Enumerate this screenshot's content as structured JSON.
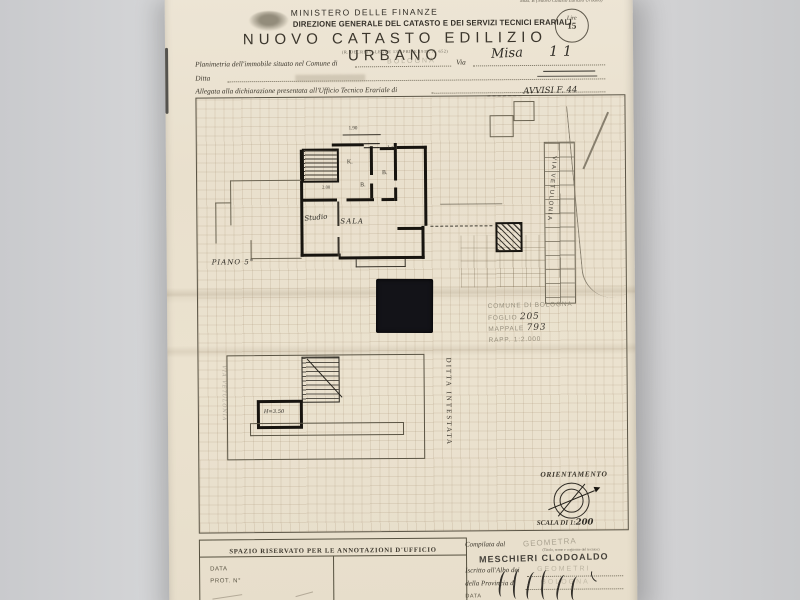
{
  "header": {
    "mod_label": "Mod. B (Nuovo Catasto Edilizio Urbano)",
    "ministry": "MINISTERO DELLE FINANZE",
    "directorate": "DIREZIONE GENERALE DEL CATASTO E DEI SERVIZI TECNICI ERARIALI",
    "title": "NUOVO CATASTO EDILIZIO URBANO",
    "subtitle": "(R. DECRETO-LEGGE 13 APRILE 1939, N. 652)",
    "fee_stamp": {
      "currency": "Lire",
      "amount": "15"
    }
  },
  "form": {
    "line1_label": "Planimetria dell'immobile situato nel Comune di",
    "comune_stamp": "BOLOGNA",
    "via_label": "Via",
    "via_value": "Misa",
    "civico_value": "11",
    "ditta_label": "Ditta",
    "line3_label": "Allegata alla dichiarazione presentata all'Ufficio Tecnico Erariale di",
    "annotation": "AVVISI F. 44"
  },
  "plan_upper": {
    "floor_label": "PIANO 5°",
    "rooms": {
      "kitchen": "K.",
      "bath1": "B.",
      "bath2": "B.",
      "sala": "SALA",
      "studio": "Studio"
    },
    "dims": {
      "top": "1.90",
      "right": "1.15",
      "hall": "2.00"
    }
  },
  "site_plan": {
    "street": "VIA VETULONIA",
    "stamp": {
      "line1": "COMUNE DI BOLOGNA",
      "foglio_label": "FOGLIO",
      "foglio_value": "205",
      "mappale_label": "MAPPALE",
      "mappale_value": "793",
      "rapp": "RAPP. 1:2.000"
    }
  },
  "plan_lower": {
    "height_label": "H=3.50",
    "ditta_vertical": "DITTA INTESTATA",
    "street_pencil": "VIA VETULONIA"
  },
  "orientation": {
    "label": "ORIENTAMENTO",
    "scale_label": "SCALA DI 1:",
    "scale_value": "200"
  },
  "footer": {
    "spazio_title": "SPAZIO RISERVATO PER LE ANNOTAZIONI D'UFFICIO",
    "data_label": "DATA",
    "prot_label": "PROT. N°",
    "compiled_label": "Compilata dal",
    "compiled_sub": "(Titolo, nome e cognome del tecnico)",
    "role_stamp": "GEOMETRA",
    "name_stamp": "MESCHIERI CLODOALDO",
    "register_label": "Iscritto all'Albo dei",
    "register_stamp": "GEOMETRI",
    "province_label": "della Provincia di",
    "province_stamp": "BOLOGNA",
    "date_label": "DATA"
  },
  "colors": {
    "paper": "#ebe3d1",
    "ink": "#3a352c",
    "stamp_gray": "#97907e",
    "plan_wall": "#17140f"
  }
}
